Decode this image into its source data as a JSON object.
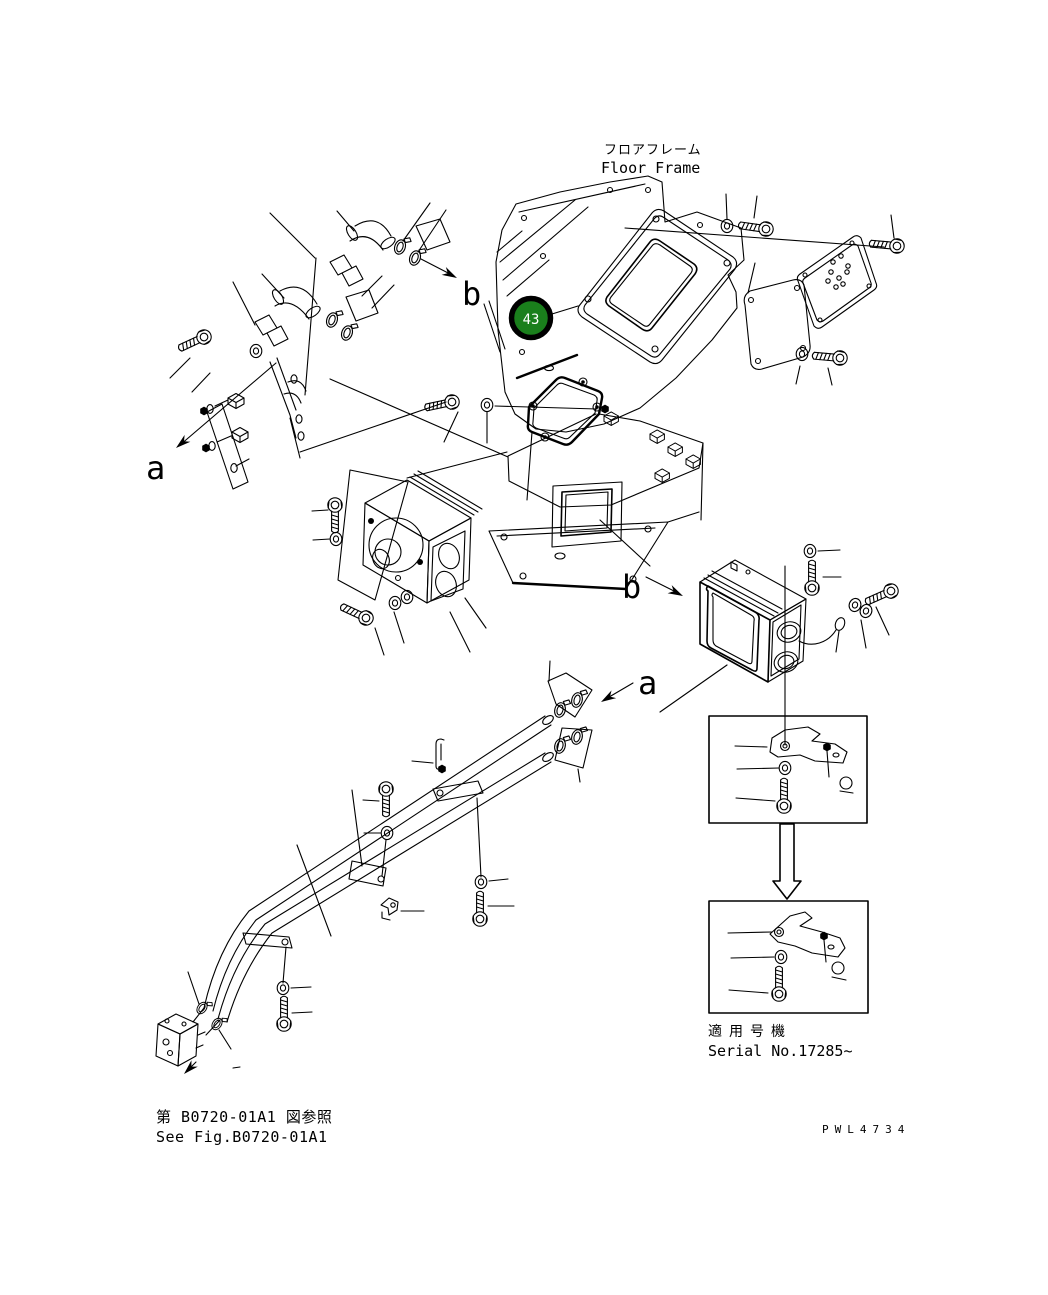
{
  "page": {
    "background": "#ffffff",
    "ink": "#000000"
  },
  "header": {
    "title_jp": "フロアフレーム",
    "title_en": "Floor Frame"
  },
  "callout": {
    "number": "43",
    "color": "#1a7f1c",
    "ring_color": "#000000",
    "text_color": "#ffffff"
  },
  "view_labels": {
    "b_upper": "b",
    "a_upper": "a",
    "b_lower": "b",
    "a_lower": "a"
  },
  "serial_note": {
    "jp": "適用号機",
    "en": "Serial No.17285~"
  },
  "footer": {
    "reference_jp": "第 B0720-01A1 図参照",
    "reference_en": "See Fig.B0720-01A1"
  },
  "watermark": "PWL4734"
}
